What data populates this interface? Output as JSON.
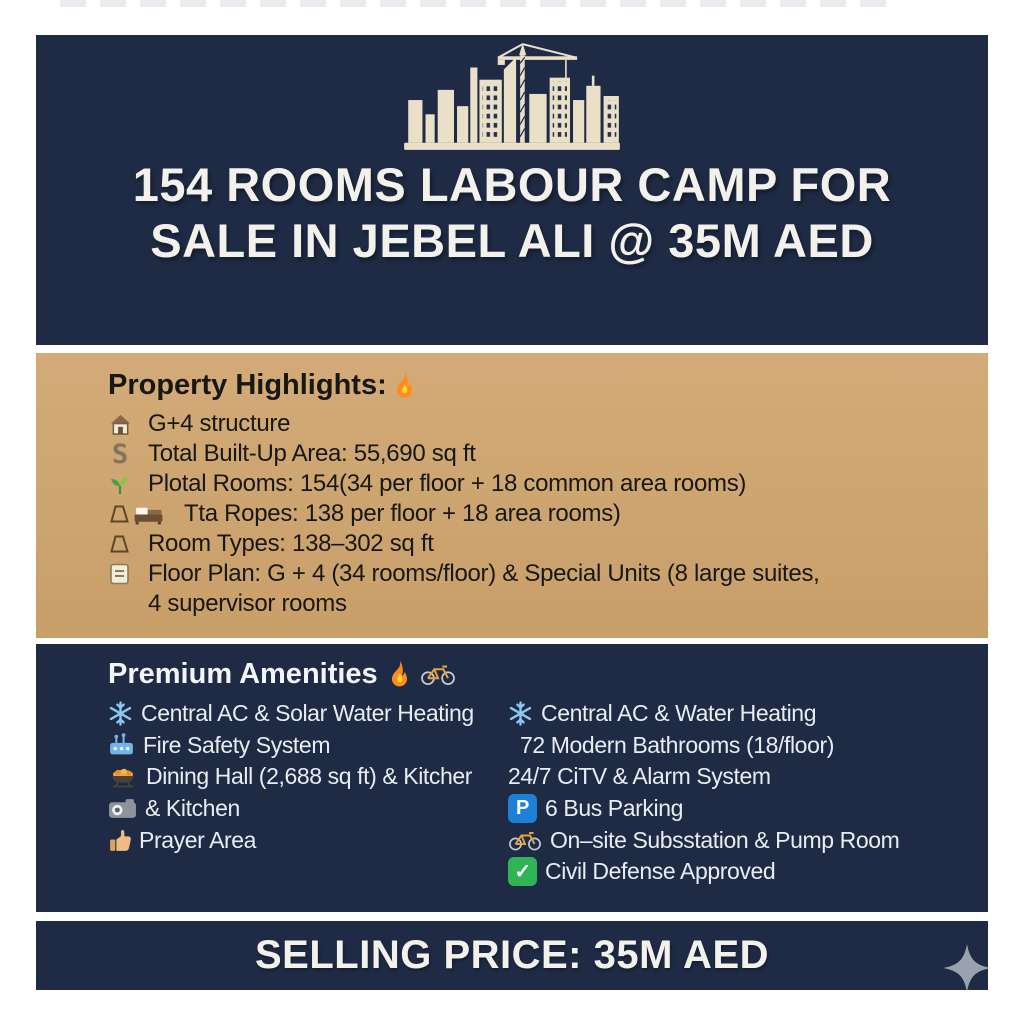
{
  "colors": {
    "navy": "#1f2b45",
    "tan": "#cda571",
    "cream": "#eae0c8",
    "title_text": "#f3f1ec",
    "highlight_text": "#191713",
    "amenity_text": "#e9edf3",
    "parking_blue": "#1d7fd6",
    "check_green": "#2fb457",
    "snowflake_blue": "#8ec8f0",
    "flame_orange": "#ff8c1a",
    "star_gray": "#99a3af"
  },
  "header": {
    "graphic": "city-skyline-crane-icon",
    "title_line1": "154 ROOMS LABOUR CAMP FOR",
    "title_line2": "SALE IN JEBEL ALI @ 35M AED"
  },
  "highlights": {
    "heading": "Property Highlights:",
    "heading_icon": "flame-icon",
    "items": [
      {
        "icon": "house-icon",
        "text": "G+4 structure"
      },
      {
        "icon": "s-icon",
        "text": "Total Built-Up Area: 55,690 sq ft"
      },
      {
        "icon": "seedling-icon",
        "text": "Plotal Rooms: 154(34 per floor + 18 common area rooms)"
      },
      {
        "icon": "trapezoid-icon bed-icon",
        "text": "Tta Ropes: 138 per floor + 18 area rooms)"
      },
      {
        "icon": "trapezoid-icon",
        "text": "Room Types: 138–302 sq ft"
      },
      {
        "icon": "note-icon",
        "text": "Floor Plan: G + 4 (34 rooms/floor) & Special Units (8 large suites,",
        "text2": "4 supervisor rooms"
      }
    ]
  },
  "amenities": {
    "heading": "Premium Amenities",
    "heading_icons": [
      "flame-icon",
      "bicycle-icon"
    ],
    "rows": [
      {
        "left": {
          "icon": "snowflake-icon",
          "text": "Central AC & Solar Water Heating"
        },
        "right": {
          "icon": "snowflake-icon",
          "text": "Central AC & Water Heating"
        }
      },
      {
        "left": {
          "icon": "fire-safety-icon",
          "text": "Fire Safety System"
        },
        "right": {
          "icon": "",
          "text": "72 Modern Bathrooms (18/floor)"
        }
      },
      {
        "left": {
          "icon": "dining-icon",
          "text": "Dining Hall (2,688 sq ft) & Kitcher"
        },
        "right": {
          "icon": "",
          "text": "24/7 CiTV & Alarm System"
        }
      },
      {
        "left": {
          "icon": "camera-icon",
          "text": "& Kitchen"
        },
        "right": {
          "icon": "parking-icon",
          "text": "6 Bus Parking"
        }
      },
      {
        "left": {
          "icon": "thumbs-up-icon",
          "text": "Prayer Area"
        },
        "right": {
          "icon": "bicycle-icon",
          "text": "On–site Subsstation & Pump Room"
        }
      },
      {
        "left": {
          "icon": "",
          "text": ""
        },
        "right": {
          "icon": "check-icon",
          "text": "Civil Defense Approved"
        }
      }
    ]
  },
  "footer": {
    "price_label": "SELLING PRICE: 35M AED",
    "decoration": "sparkle-icon"
  }
}
